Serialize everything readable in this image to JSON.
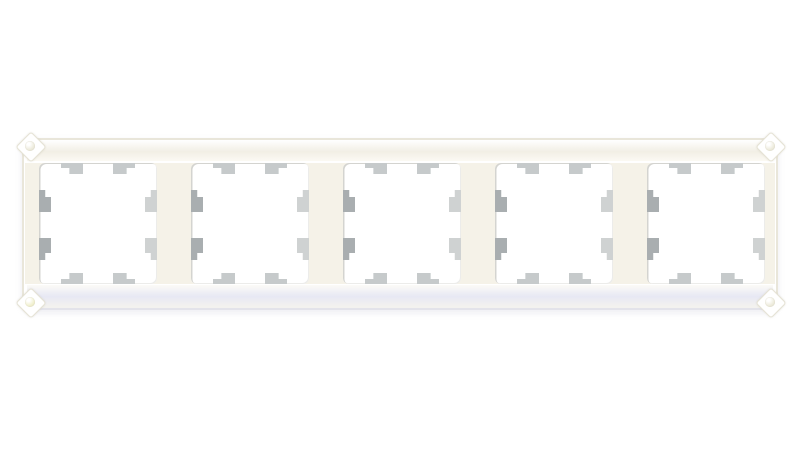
{
  "photo": {
    "subject": "White five-gang wall switch and socket surround frame with classic chamfered corners, front view on a plain white background",
    "background_color": "#ffffff"
  },
  "frame": {
    "gang_count": 5,
    "mounting_tabs_per_opening": {
      "top": 2,
      "bottom": 2,
      "left": 2,
      "right": 2
    },
    "colors": {
      "background": "#ffffff",
      "frame_white": "#ffffff",
      "frame_edge": "#e9e6da",
      "frame_top_sheen": "#f2efe5",
      "divider_cream": "#f5f2e8",
      "opening_white": "#ffffff",
      "opening_edge": "#d4d4d0",
      "tab_mid": "#c6cacb",
      "tab_dark": "#a9aeb0",
      "tab_light": "#cfd2d2",
      "bottom_sheen": "#e7e8f4",
      "corner_dimple": "#edebdc",
      "corner_dimple_yellow": "#f1f0cf"
    }
  }
}
